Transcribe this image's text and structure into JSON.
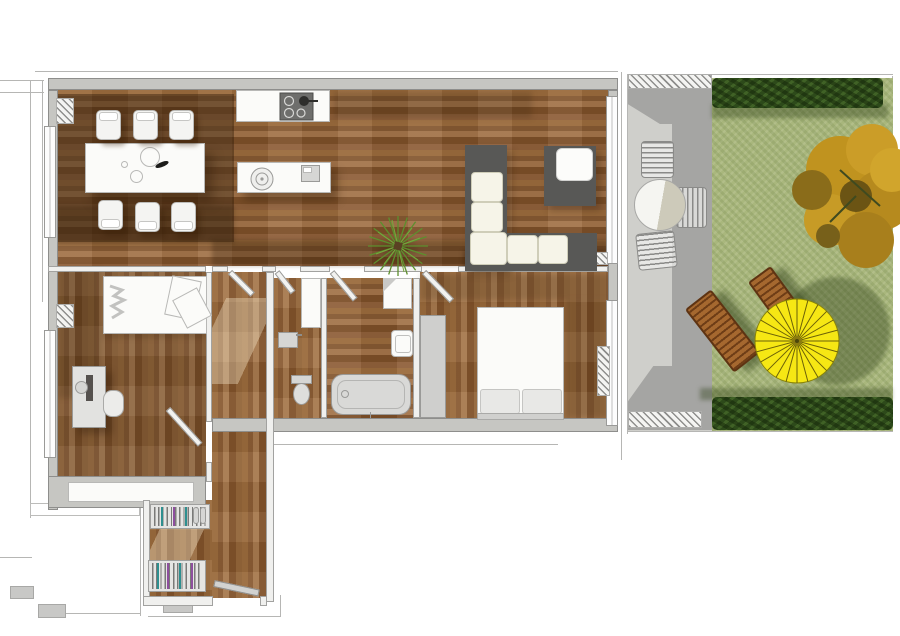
{
  "scene": {
    "type": "3d-floor-plan-top-view",
    "description": "Rendered top-down floor plan of an apartment with adjoining patio and garden terrace",
    "canvas": {
      "width": 900,
      "height": 636
    }
  },
  "palette": {
    "background": "#ffffff",
    "wall_exterior": "#c6c6c2",
    "wall_edge": "#8e8e8c",
    "wood_light": "#a7794e",
    "wood_mid": "#8a5c34",
    "wood_dark": "#5f3d1e",
    "rug_shadow": "rgba(46,26,8,0.42)",
    "lawn": "#a9b77d",
    "hedge": "#2d4a1a",
    "patio_light": "#cfcfcb",
    "patio_dark": "#a5a5a3",
    "parasol": "#f6e714",
    "parasol_spokes": "#6b6008",
    "lounger_wood": "#a5682f",
    "tree_gold": "#c79b26",
    "tree_olive": "#77601a",
    "sofa_base": "#585856",
    "cushion": "#f6f4e8",
    "fixture_gray": "#d6d6d4",
    "hanger_teal": "#2e8f8f",
    "hanger_purple": "#8e4f9e",
    "plant_green": "#5d8f2e"
  },
  "apartment": {
    "living_dining_kitchen": {
      "furniture": [
        "dining-table",
        "dining-chair-x6",
        "plates-decor",
        "kitchen-counter",
        "cooktop-4-burners",
        "kitchen-island",
        "round-sink",
        "small-appliance",
        "potted-plant",
        "corner-sofa-white",
        "armchair-dark",
        "radiator",
        "windows"
      ]
    },
    "bedroom_left": {
      "furniture": [
        "single-bed",
        "rumpled-duvet",
        "desk",
        "monitor",
        "desk-chair",
        "built-in-wardrobe",
        "radiator",
        "door"
      ]
    },
    "wc": {
      "furniture": [
        "toilet",
        "hand-basin",
        "tall-cabinet",
        "door"
      ]
    },
    "bathroom": {
      "furniture": [
        "bathtub",
        "washbasin",
        "shower-tray",
        "door"
      ]
    },
    "bedroom_right": {
      "furniture": [
        "double-bed",
        "pillow-x2",
        "wardrobe",
        "radiator",
        "window",
        "door"
      ]
    },
    "hallway_entry": {
      "furniture": [
        "coat-rack-with-hangers-x2",
        "shoes-pair",
        "entrance-door-open"
      ]
    }
  },
  "terrace": {
    "patio": {
      "items": [
        "round-bistro-table",
        "patio-chair-x3",
        "pergola-hatch",
        "drain-grate"
      ]
    },
    "garden": {
      "items": [
        "lawn",
        "hedge-top",
        "hedge-bottom",
        "autumn-tree-gold",
        "yellow-parasol",
        "sun-lounger-x2",
        "parasol-shadow"
      ]
    },
    "counts": {
      "parasol_segments": 24,
      "patio_chairs": 3,
      "sun_loungers": 2,
      "dining_chairs": 6
    }
  }
}
